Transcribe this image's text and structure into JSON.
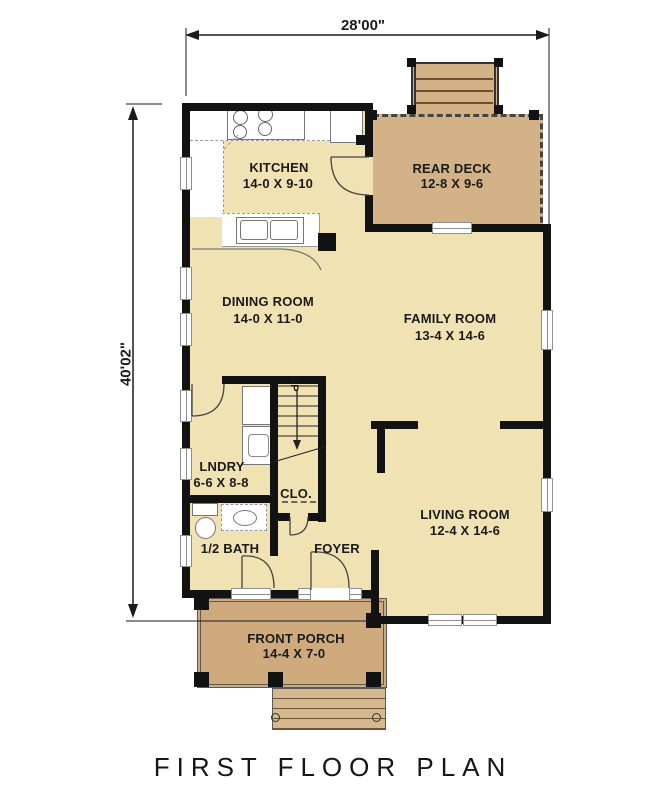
{
  "plan": {
    "title": "FIRST FLOOR PLAN",
    "dim_width": "28'00\"",
    "dim_height": "40'02\"",
    "stairs_label": "UP",
    "rooms": {
      "kitchen": {
        "name": "KITCHEN",
        "size": "14-0 X 9-10"
      },
      "rear_deck": {
        "name": "REAR DECK",
        "size": "12-8 X 9-6"
      },
      "dining_room": {
        "name": "DINING ROOM",
        "size": "14-0 X 11-0"
      },
      "family_room": {
        "name": "FAMILY ROOM",
        "size": "13-4 X 14-6"
      },
      "laundry": {
        "name": "LNDRY",
        "size": "6-6 X 8-8"
      },
      "closet": {
        "name": "CLO."
      },
      "half_bath": {
        "name": "1/2 BATH"
      },
      "foyer": {
        "name": "FOYER"
      },
      "living_room": {
        "name": "LIVING ROOM",
        "size": "12-4 X 14-6"
      },
      "front_porch": {
        "name": "FRONT PORCH",
        "size": "14-4 X 7-0"
      }
    },
    "colors": {
      "floor": "#f1e2b3",
      "deck": "#d3b287",
      "porch": "#cfaa7d",
      "steps": "#d6b88f",
      "wall": "#121212",
      "background": "#ffffff"
    }
  }
}
